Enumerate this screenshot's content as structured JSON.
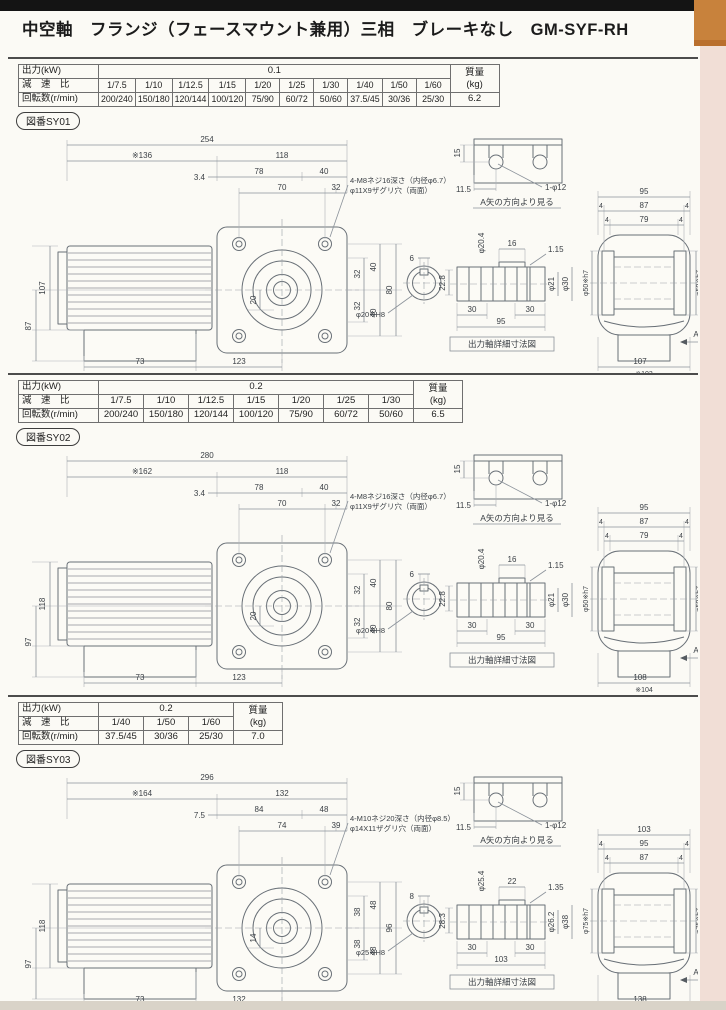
{
  "header": {
    "title": "中空軸　フランジ（フェースマウント兼用）三相　ブレーキなし　GM-SYF-RH",
    "bar_color": "#141414",
    "edge_tab_color": "#c8823c",
    "edge_strip_color": "#f1ded6"
  },
  "sections": [
    {
      "table": {
        "output_label": "出力(kW)",
        "output_value": "0.1",
        "ratio_label": "減　速　比",
        "speed_label": "回転数(r/min)",
        "mass_label": "質量",
        "mass_unit": "(kg)",
        "mass_value": "6.2",
        "ratios": [
          "1/7.5",
          "1/10",
          "1/12.5",
          "1/15",
          "1/20",
          "1/25",
          "1/30",
          "1/40",
          "1/50",
          "1/60"
        ],
        "speeds": [
          "200/240",
          "150/180",
          "120/144",
          "100/120",
          "75/90",
          "60/72",
          "50/60",
          "37.5/45",
          "30/36",
          "25/30"
        ]
      },
      "fig_label": "図番SY01",
      "drawing": {
        "note1": "4-M8ネジ16深さ（内径φ6.7）",
        "note2": "φ11X9ザグリ穴（両面）",
        "dims": {
          "overall": "254",
          "motor": "※136",
          "flange": "118",
          "lip": "3.4",
          "a": "78",
          "b": "40",
          "c": "70",
          "d": "32",
          "h1": "107",
          "h2": "87",
          "v1": "32",
          "v2": "32",
          "v3": "40",
          "v4": "40",
          "v5": "80",
          "hub": "20",
          "f1": "73",
          "f2": "123"
        },
        "detail": {
          "h": "15",
          "off": "11.5",
          "hole": "1-φ12",
          "caption": "A矢の方向より見る"
        },
        "sec": {
          "key_w": "6",
          "key_h": "22.8",
          "bore": "φ20※H8"
        },
        "shaft": {
          "step": "16",
          "groove_w": "1.15",
          "groove_d": "φ20.4",
          "d1": "φ21",
          "d2": "φ30",
          "l1": "30",
          "l2": "30",
          "len": "95",
          "caption": "出力軸詳細寸法図"
        },
        "right": {
          "w": "95",
          "e": "4",
          "m1": "87",
          "m2": "79",
          "spigot": "φ50※h7",
          "bw": "107",
          "bw2": "※103",
          "arrow": "A"
        }
      }
    },
    {
      "table": {
        "output_label": "出力(kW)",
        "output_value": "0.2",
        "ratio_label": "減　速　比",
        "speed_label": "回転数(r/min)",
        "mass_label": "質量",
        "mass_unit": "(kg)",
        "mass_value": "6.5",
        "ratios": [
          "1/7.5",
          "1/10",
          "1/12.5",
          "1/15",
          "1/20",
          "1/25",
          "1/30"
        ],
        "speeds": [
          "200/240",
          "150/180",
          "120/144",
          "100/120",
          "75/90",
          "60/72",
          "50/60"
        ]
      },
      "fig_label": "図番SY02",
      "drawing": {
        "note1": "4-M8ネジ16深さ（内径φ6.7）",
        "note2": "φ11X9ザグリ穴（両面）",
        "dims": {
          "overall": "280",
          "motor": "※162",
          "flange": "118",
          "lip": "3.4",
          "a": "78",
          "b": "40",
          "c": "70",
          "d": "32",
          "h1": "118",
          "h2": "97",
          "v1": "32",
          "v2": "32",
          "v3": "40",
          "v4": "40",
          "v5": "80",
          "hub": "20",
          "f1": "73",
          "f2": "123"
        },
        "detail": {
          "h": "15",
          "off": "11.5",
          "hole": "1-φ12",
          "caption": "A矢の方向より見る"
        },
        "sec": {
          "key_w": "6",
          "key_h": "22.8",
          "bore": "φ20※H8"
        },
        "shaft": {
          "step": "16",
          "groove_w": "1.15",
          "groove_d": "φ20.4",
          "d1": "φ21",
          "d2": "φ30",
          "l1": "30",
          "l2": "30",
          "len": "95",
          "caption": "出力軸詳細寸法図"
        },
        "right": {
          "w": "95",
          "e": "4",
          "m1": "87",
          "m2": "79",
          "spigot": "φ50※h7",
          "bw": "108",
          "bw2": "※104",
          "arrow": "A"
        }
      }
    },
    {
      "table": {
        "output_label": "出力(kW)",
        "output_value": "0.2",
        "ratio_label": "減　速　比",
        "speed_label": "回転数(r/min)",
        "mass_label": "質量",
        "mass_unit": "(kg)",
        "mass_value": "7.0",
        "ratios": [
          "1/40",
          "1/50",
          "1/60"
        ],
        "speeds": [
          "37.5/45",
          "30/36",
          "25/30"
        ]
      },
      "fig_label": "図番SY03",
      "drawing": {
        "note1": "4-M10ネジ20深さ（内径φ8.5）",
        "note2": "φ14X11ザグリ穴（両面）",
        "dims": {
          "overall": "296",
          "motor": "※164",
          "flange": "132",
          "lip": "7.5",
          "a": "84",
          "b": "48",
          "c": "74",
          "d": "39",
          "h1": "118",
          "h2": "97",
          "v1": "38",
          "v2": "38",
          "v3": "48",
          "v4": "48",
          "v5": "96",
          "hub": "14",
          "f1": "73",
          "f2": "132"
        },
        "detail": {
          "h": "15",
          "off": "11.5",
          "hole": "1-φ12",
          "caption": "A矢の方向より見る"
        },
        "sec": {
          "key_w": "8",
          "key_h": "28.3",
          "bore": "φ25※H8"
        },
        "shaft": {
          "step": "22",
          "groove_w": "1.35",
          "groove_d": "φ25.4",
          "d1": "φ26.2",
          "d2": "φ38",
          "l1": "30",
          "l2": "30",
          "len": "103",
          "caption": "出力軸詳細寸法図"
        },
        "right": {
          "w": "103",
          "e": "4",
          "m1": "95",
          "m2": "87",
          "spigot": "φ75※h7",
          "bw": "138",
          "bw2": "※134",
          "arrow": "A"
        }
      }
    }
  ]
}
